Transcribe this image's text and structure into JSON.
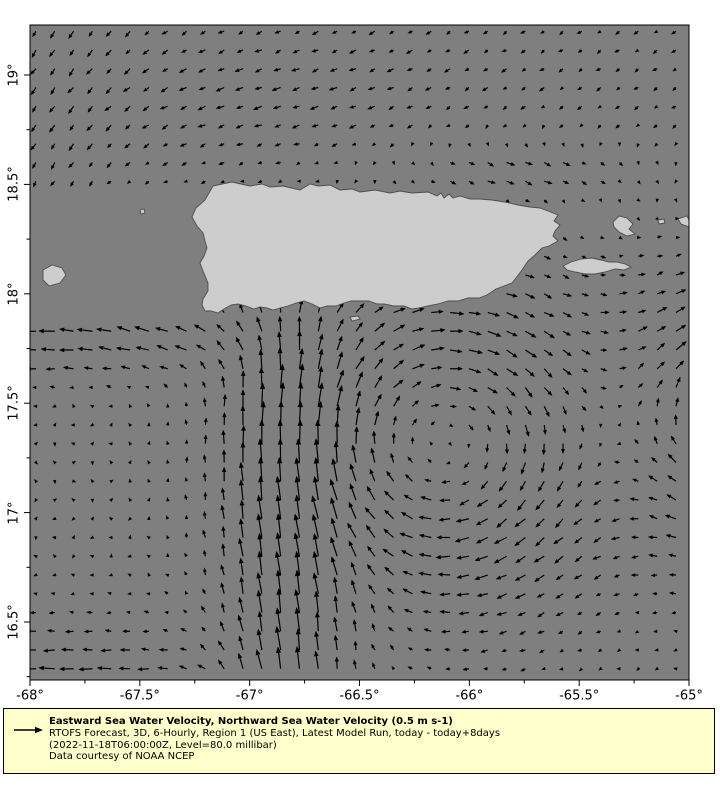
{
  "legend": {
    "title": "Eastward Sea Water Velocity, Northward Sea Water Velocity (0.5 m s-1)",
    "line2": "RTOFS Forecast, 3D, 6-Hourly, Region 1 (US East), Latest Model Run, today - today+8days",
    "line3": "(2022-11-18T06:00:00Z, Level=80.0 millibar)",
    "line4": "Data courtesy of NOAA NCEP",
    "reference_arrow": {
      "value_m_s": 0.5,
      "length_px": 22
    }
  },
  "chart_data": {
    "type": "quiver",
    "title": "",
    "xlabel": "",
    "ylabel": "",
    "xlim": [
      -68,
      -65
    ],
    "ylim": [
      16.236,
      19.2285
    ],
    "colors": {
      "sea": "#7f7f7f",
      "land_fill": "#cdcdcd",
      "land_stroke": "#4d4d4d",
      "arrow": "#000000",
      "frame": "#000000",
      "page_bg": "#ffffff",
      "legend_bg": "#ffffcc"
    },
    "projection": {
      "x0": 30,
      "y0": 25,
      "lon_min": -68,
      "lat_max": 19.2285,
      "px_per_deg_x": 219.67,
      "px_per_deg_y": 218.8,
      "plot_w": 659,
      "plot_h": 655
    },
    "axes": {
      "xticks": [
        {
          "lon": -68,
          "label": "-68°"
        },
        {
          "lon": -67.5,
          "label": "-67.5°"
        },
        {
          "lon": -67,
          "label": "-67°"
        },
        {
          "lon": -66.5,
          "label": "-66.5°"
        },
        {
          "lon": -66,
          "label": "-66°"
        },
        {
          "lon": -65.5,
          "label": "-65.5°"
        },
        {
          "lon": -65,
          "label": "-65°"
        }
      ],
      "yticks": [
        {
          "lat": 19,
          "label": "19°"
        },
        {
          "lat": 18.5,
          "label": "18.5°"
        },
        {
          "lat": 18,
          "label": "18°"
        },
        {
          "lat": 17.5,
          "label": "17.5°"
        },
        {
          "lat": 17,
          "label": "17°"
        },
        {
          "lat": 16.5,
          "label": "16.5°"
        }
      ],
      "minor_step_deg": 0.25,
      "major_tick_len": 6,
      "minor_tick_len": 3.5
    },
    "grid": {
      "lon_start": -67.973,
      "lat_start": 19.2,
      "step_deg": 0.0857,
      "cols": 35,
      "rows": 35
    },
    "flow_model": {
      "scale_px_per_ms": 40,
      "max_arrow_px": 24,
      "vortices": [
        {
          "name": "anticyclone-south-of-pr",
          "lon": -66.12,
          "lat": 17.32,
          "amp": 1.15,
          "sigma": 0.7,
          "rotation": "clockwise"
        },
        {
          "name": "anticyclone-east-edge",
          "lon": -64.65,
          "lat": 17.45,
          "amp": 1.4,
          "sigma": 0.6,
          "rotation": "clockwise"
        }
      ],
      "jets": [
        {
          "name": "northward-jet",
          "type": "meridional",
          "lon": -66.85,
          "width": 0.28,
          "v": 0.52,
          "lat_max": 17.75,
          "ramp": 0.25
        },
        {
          "name": "westward-band-sw",
          "type": "zonal",
          "lat": 17.8,
          "width": 0.2,
          "u": -0.4,
          "lon_max": -66.95,
          "ramp": 0.25
        },
        {
          "name": "westward-current-bottom",
          "type": "zonal",
          "lat": 16.12,
          "width": 0.38,
          "u": -0.5,
          "lon_max": -67.3,
          "ramp": 0.25
        },
        {
          "name": "mona-passage-north",
          "type": "blob",
          "lon": -67.5,
          "lat": 18.1,
          "sx": 0.3,
          "sy": 0.35,
          "u": 0,
          "v": 0.15
        },
        {
          "name": "eastward-counterflow-ne",
          "type": "blob",
          "lon": -65.75,
          "lat": 18.57,
          "sx": 0.55,
          "sy": 0.13,
          "u": 0.26,
          "v": 0
        },
        {
          "name": "jet-fan-ne",
          "type": "blob",
          "lon": -66.5,
          "lat": 16.55,
          "sx": 0.3,
          "sy": 0.4,
          "u": 0.12,
          "v": 0.08
        }
      ],
      "background": {
        "lat_min": 18.35,
        "ramp": 0.1,
        "u": -0.1,
        "v": -0.07,
        "west_band": {
          "lat": 18.9,
          "sy": 0.3,
          "lon": -66.9,
          "sx": 0.8,
          "u": -0.1
        },
        "south_push_west": {
          "lon": -67.9,
          "sx": 0.45,
          "v": -0.1
        }
      },
      "noise": {
        "amp": 0.025
      }
    },
    "land": {
      "puerto_rico": [
        [
          162,
          192
        ],
        [
          166,
          183
        ],
        [
          175,
          175
        ],
        [
          183,
          161
        ],
        [
          192,
          159
        ],
        [
          202,
          157
        ],
        [
          220,
          161
        ],
        [
          232,
          159
        ],
        [
          240,
          162
        ],
        [
          253,
          161
        ],
        [
          270,
          165
        ],
        [
          280,
          159
        ],
        [
          288,
          161
        ],
        [
          300,
          160
        ],
        [
          310,
          165
        ],
        [
          322,
          164
        ],
        [
          330,
          167
        ],
        [
          345,
          165
        ],
        [
          360,
          168
        ],
        [
          370,
          166
        ],
        [
          382,
          168
        ],
        [
          398,
          167
        ],
        [
          407,
          171
        ],
        [
          411,
          168
        ],
        [
          414,
          173
        ],
        [
          419,
          169
        ],
        [
          423,
          173
        ],
        [
          430,
          171
        ],
        [
          440,
          174
        ],
        [
          450,
          174
        ],
        [
          462,
          175
        ],
        [
          475,
          177
        ],
        [
          488,
          180
        ],
        [
          500,
          182
        ],
        [
          510,
          183
        ],
        [
          518,
          186
        ],
        [
          528,
          190
        ],
        [
          524,
          196
        ],
        [
          530,
          200
        ],
        [
          525,
          206
        ],
        [
          523,
          211
        ],
        [
          528,
          216
        ],
        [
          519,
          221
        ],
        [
          512,
          223
        ],
        [
          505,
          230
        ],
        [
          498,
          236
        ],
        [
          492,
          245
        ],
        [
          486,
          253
        ],
        [
          482,
          258
        ],
        [
          474,
          261
        ],
        [
          466,
          264
        ],
        [
          457,
          270
        ],
        [
          449,
          273
        ],
        [
          438,
          273
        ],
        [
          428,
          276
        ],
        [
          418,
          276
        ],
        [
          408,
          279
        ],
        [
          398,
          281
        ],
        [
          389,
          283
        ],
        [
          382,
          284
        ],
        [
          374,
          281
        ],
        [
          364,
          281
        ],
        [
          354,
          279
        ],
        [
          347,
          279
        ],
        [
          339,
          276
        ],
        [
          330,
          276
        ],
        [
          321,
          276
        ],
        [
          314,
          278
        ],
        [
          306,
          281
        ],
        [
          297,
          281
        ],
        [
          290,
          283
        ],
        [
          282,
          279
        ],
        [
          274,
          276
        ],
        [
          266,
          278
        ],
        [
          258,
          281
        ],
        [
          250,
          283
        ],
        [
          243,
          285
        ],
        [
          237,
          283
        ],
        [
          230,
          282
        ],
        [
          224,
          284
        ],
        [
          216,
          281
        ],
        [
          208,
          279
        ],
        [
          201,
          280
        ],
        [
          194,
          284
        ],
        [
          188,
          288
        ],
        [
          181,
          286
        ],
        [
          175,
          286
        ],
        [
          172,
          280
        ],
        [
          173,
          274
        ],
        [
          178,
          266
        ],
        [
          178,
          258
        ],
        [
          173,
          246
        ],
        [
          170,
          238
        ],
        [
          174,
          231
        ],
        [
          177,
          223
        ],
        [
          175,
          216
        ],
        [
          173,
          208
        ],
        [
          167,
          201
        ]
      ],
      "vieques": [
        [
          533,
          241
        ],
        [
          541,
          237
        ],
        [
          551,
          234
        ],
        [
          562,
          233
        ],
        [
          571,
          235
        ],
        [
          579,
          237
        ],
        [
          587,
          237
        ],
        [
          595,
          239
        ],
        [
          601,
          242
        ],
        [
          594,
          245
        ],
        [
          585,
          244
        ],
        [
          575,
          247
        ],
        [
          565,
          249
        ],
        [
          555,
          249
        ],
        [
          545,
          247
        ],
        [
          537,
          245
        ]
      ],
      "culebra": [
        [
          583,
          197
        ],
        [
          589,
          191
        ],
        [
          597,
          193
        ],
        [
          603,
          199
        ],
        [
          599,
          204
        ],
        [
          605,
          209
        ],
        [
          597,
          211
        ],
        [
          589,
          207
        ],
        [
          584,
          202
        ]
      ],
      "st_thomas": [
        [
          648,
          194
        ],
        [
          657,
          191
        ],
        [
          659,
          195
        ],
        [
          659,
          202
        ],
        [
          651,
          199
        ]
      ],
      "mona": [
        [
          13,
          245
        ],
        [
          22,
          240
        ],
        [
          32,
          243
        ],
        [
          36,
          250
        ],
        [
          30,
          258
        ],
        [
          19,
          261
        ],
        [
          13,
          255
        ]
      ],
      "desecheo": [
        [
          110,
          185
        ],
        [
          114,
          184
        ],
        [
          115,
          188
        ],
        [
          111,
          189
        ]
      ],
      "caja_de_muertos": [
        [
          320,
          292
        ],
        [
          328,
          291
        ],
        [
          330,
          294
        ],
        [
          322,
          296
        ]
      ],
      "small_cay_east": [
        [
          628,
          195
        ],
        [
          634,
          194
        ],
        [
          635,
          198
        ],
        [
          629,
          199
        ]
      ]
    }
  }
}
